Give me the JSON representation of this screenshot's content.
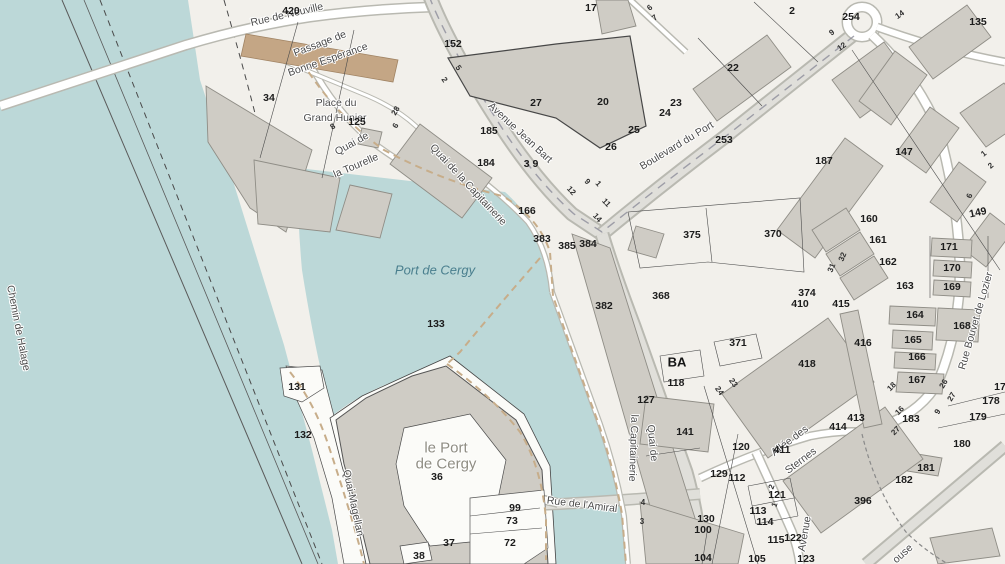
{
  "map_title": "Port de Cergy cadastral map",
  "colors": {
    "land": "#f2f0eb",
    "water": "#bcd8d8",
    "green": "#e7eeda",
    "green2": "#dce6c9",
    "parcel": "#fbfbf8",
    "bld": "#cfccc5",
    "bldstroke": "#8f8d86",
    "tan": "#c4a685",
    "road": "#ffffff",
    "major": "#e0dfda",
    "casing": "#b9b9b1",
    "quay": "#c7ad8a"
  },
  "labels": {
    "streets": [
      {
        "t": "Rue de Neuville",
        "x": 287,
        "y": 15,
        "r": -13
      },
      {
        "t": "Passage de",
        "x": 320,
        "y": 44,
        "r": -21
      },
      {
        "t": "Bonne Espérance",
        "x": 328,
        "y": 60,
        "r": -19
      },
      {
        "t": "Place du",
        "x": 336,
        "y": 103,
        "r": 0
      },
      {
        "t": "Grand Hunier",
        "x": 335,
        "y": 118,
        "r": 0
      },
      {
        "t": "Quai de",
        "x": 352,
        "y": 144,
        "r": -29
      },
      {
        "t": "la Tourelle",
        "x": 356,
        "y": 166,
        "r": -23
      },
      {
        "t": "Avenue Jean Bart",
        "x": 520,
        "y": 133,
        "r": 43
      },
      {
        "t": "Boulevard du Port",
        "x": 677,
        "y": 146,
        "r": -31
      },
      {
        "t": "Quai de la Capitainerie",
        "x": 468,
        "y": 185,
        "r": 47
      },
      {
        "t": "Quai de",
        "x": 652,
        "y": 443,
        "r": 84
      },
      {
        "t": "la Capitainerie",
        "x": 633,
        "y": 448,
        "r": 92
      },
      {
        "t": "Quai Magellan",
        "x": 353,
        "y": 503,
        "r": 78
      },
      {
        "t": "Rue de l'Amiral",
        "x": 582,
        "y": 505,
        "r": 7
      },
      {
        "t": "Chemin de Halage",
        "x": 18,
        "y": 328,
        "r": 79
      },
      {
        "t": "Allée des",
        "x": 790,
        "y": 441,
        "r": -37
      },
      {
        "t": "Sternes",
        "x": 801,
        "y": 461,
        "r": -37
      },
      {
        "t": "Rue Bouvet de Lozier",
        "x": 976,
        "y": 321,
        "r": -74
      },
      {
        "t": "Avenue",
        "x": 805,
        "y": 534,
        "r": -80
      },
      {
        "t": "ouse",
        "x": 903,
        "y": 554,
        "r": -42
      }
    ],
    "places": [
      {
        "t": "le Port",
        "x": 446,
        "y": 448,
        "r": 0
      },
      {
        "t": "de Cergy",
        "x": 446,
        "y": 464,
        "r": 0
      }
    ],
    "water_names": [
      {
        "t": "Port de Cergy",
        "x": 435,
        "y": 270,
        "r": 0
      }
    ],
    "sections": [
      {
        "t": "BA",
        "x": 677,
        "y": 362,
        "r": 0
      }
    ],
    "parcels": [
      {
        "t": "420",
        "x": 291,
        "y": 11
      },
      {
        "t": "152",
        "x": 453,
        "y": 44
      },
      {
        "t": "17",
        "x": 591,
        "y": 8
      },
      {
        "t": "34",
        "x": 269,
        "y": 98
      },
      {
        "t": "125",
        "x": 357,
        "y": 122
      },
      {
        "t": "185",
        "x": 489,
        "y": 131
      },
      {
        "t": "184",
        "x": 486,
        "y": 163
      },
      {
        "t": "3 9",
        "x": 531,
        "y": 164
      },
      {
        "t": "166",
        "x": 527,
        "y": 211
      },
      {
        "t": "383",
        "x": 542,
        "y": 239
      },
      {
        "t": "385",
        "x": 567,
        "y": 246
      },
      {
        "t": "384",
        "x": 588,
        "y": 244
      },
      {
        "t": "27",
        "x": 536,
        "y": 103
      },
      {
        "t": "20",
        "x": 603,
        "y": 102
      },
      {
        "t": "22",
        "x": 733,
        "y": 68
      },
      {
        "t": "23",
        "x": 676,
        "y": 103
      },
      {
        "t": "24",
        "x": 665,
        "y": 113
      },
      {
        "t": "25",
        "x": 634,
        "y": 130
      },
      {
        "t": "26",
        "x": 611,
        "y": 147
      },
      {
        "t": "253",
        "x": 724,
        "y": 140
      },
      {
        "t": "254",
        "x": 851,
        "y": 17
      },
      {
        "t": "2",
        "x": 792,
        "y": 11
      },
      {
        "t": "135",
        "x": 978,
        "y": 22
      },
      {
        "t": "147",
        "x": 904,
        "y": 152
      },
      {
        "t": "187",
        "x": 824,
        "y": 161
      },
      {
        "t": "160",
        "x": 869,
        "y": 219
      },
      {
        "t": "161",
        "x": 878,
        "y": 240
      },
      {
        "t": "162",
        "x": 888,
        "y": 262
      },
      {
        "t": "163",
        "x": 905,
        "y": 286
      },
      {
        "t": "149",
        "x": 978,
        "y": 213,
        "r": -12
      },
      {
        "t": "171",
        "x": 949,
        "y": 247
      },
      {
        "t": "170",
        "x": 952,
        "y": 268
      },
      {
        "t": "169",
        "x": 952,
        "y": 287
      },
      {
        "t": "168",
        "x": 962,
        "y": 326
      },
      {
        "t": "164",
        "x": 915,
        "y": 315
      },
      {
        "t": "165",
        "x": 913,
        "y": 340
      },
      {
        "t": "166",
        "x": 917,
        "y": 357
      },
      {
        "t": "167",
        "x": 917,
        "y": 380
      },
      {
        "t": "178",
        "x": 991,
        "y": 401
      },
      {
        "t": "179",
        "x": 978,
        "y": 417
      },
      {
        "t": "180",
        "x": 962,
        "y": 444
      },
      {
        "t": "181",
        "x": 926,
        "y": 468
      },
      {
        "t": "182",
        "x": 904,
        "y": 480
      },
      {
        "t": "183",
        "x": 911,
        "y": 419
      },
      {
        "t": "17",
        "x": 1000,
        "y": 387
      },
      {
        "t": "375",
        "x": 692,
        "y": 235
      },
      {
        "t": "370",
        "x": 773,
        "y": 234
      },
      {
        "t": "368",
        "x": 661,
        "y": 296
      },
      {
        "t": "382",
        "x": 604,
        "y": 306
      },
      {
        "t": "371",
        "x": 738,
        "y": 343
      },
      {
        "t": "374",
        "x": 807,
        "y": 293
      },
      {
        "t": "410",
        "x": 800,
        "y": 304
      },
      {
        "t": "415",
        "x": 841,
        "y": 304
      },
      {
        "t": "416",
        "x": 863,
        "y": 343
      },
      {
        "t": "411",
        "x": 782,
        "y": 450
      },
      {
        "t": "413",
        "x": 856,
        "y": 418
      },
      {
        "t": "414",
        "x": 838,
        "y": 427
      },
      {
        "t": "418",
        "x": 807,
        "y": 364
      },
      {
        "t": "396",
        "x": 863,
        "y": 501
      },
      {
        "t": "118",
        "x": 676,
        "y": 383
      },
      {
        "t": "127",
        "x": 646,
        "y": 400
      },
      {
        "t": "141",
        "x": 685,
        "y": 432
      },
      {
        "t": "120",
        "x": 741,
        "y": 447
      },
      {
        "t": "129",
        "x": 719,
        "y": 474
      },
      {
        "t": "112",
        "x": 737,
        "y": 478
      },
      {
        "t": "121",
        "x": 777,
        "y": 495
      },
      {
        "t": "113",
        "x": 758,
        "y": 511
      },
      {
        "t": "114",
        "x": 765,
        "y": 522
      },
      {
        "t": "130",
        "x": 706,
        "y": 519
      },
      {
        "t": "100",
        "x": 703,
        "y": 530
      },
      {
        "t": "115",
        "x": 776,
        "y": 540
      },
      {
        "t": "122",
        "x": 793,
        "y": 538
      },
      {
        "t": "104",
        "x": 703,
        "y": 558
      },
      {
        "t": "105",
        "x": 757,
        "y": 559
      },
      {
        "t": "123",
        "x": 806,
        "y": 559
      },
      {
        "t": "99",
        "x": 515,
        "y": 508
      },
      {
        "t": "73",
        "x": 512,
        "y": 521
      },
      {
        "t": "72",
        "x": 510,
        "y": 543
      },
      {
        "t": "37",
        "x": 449,
        "y": 543
      },
      {
        "t": "38",
        "x": 419,
        "y": 556
      },
      {
        "t": "36",
        "x": 437,
        "y": 477
      },
      {
        "t": "131",
        "x": 297,
        "y": 387
      },
      {
        "t": "132",
        "x": 303,
        "y": 435
      },
      {
        "t": "133",
        "x": 436,
        "y": 324
      }
    ],
    "house_numbers": [
      {
        "t": "6",
        "x": 650,
        "y": 8,
        "r": -40
      },
      {
        "t": "7",
        "x": 655,
        "y": 18,
        "r": -40
      },
      {
        "t": "5",
        "x": 458,
        "y": 68,
        "r": 55
      },
      {
        "t": "2",
        "x": 444,
        "y": 80,
        "r": 55
      },
      {
        "t": "8",
        "x": 333,
        "y": 127,
        "r": -35
      },
      {
        "t": "28",
        "x": 396,
        "y": 111,
        "r": -60
      },
      {
        "t": "6",
        "x": 396,
        "y": 126,
        "r": -60
      },
      {
        "t": "9",
        "x": 832,
        "y": 33,
        "r": -35
      },
      {
        "t": "12",
        "x": 842,
        "y": 47,
        "r": -35
      },
      {
        "t": "14",
        "x": 900,
        "y": 15,
        "r": -35
      },
      {
        "t": "9",
        "x": 587,
        "y": 182,
        "r": 48
      },
      {
        "t": "1",
        "x": 598,
        "y": 184,
        "r": 48
      },
      {
        "t": "12",
        "x": 571,
        "y": 191,
        "r": 48
      },
      {
        "t": "11",
        "x": 606,
        "y": 203,
        "r": 48
      },
      {
        "t": "14",
        "x": 597,
        "y": 218,
        "r": 48
      },
      {
        "t": "23",
        "x": 733,
        "y": 383,
        "r": 55
      },
      {
        "t": "24",
        "x": 719,
        "y": 391,
        "r": 55
      },
      {
        "t": "32",
        "x": 843,
        "y": 257,
        "r": -68
      },
      {
        "t": "31",
        "x": 832,
        "y": 268,
        "r": -68
      },
      {
        "t": "1",
        "x": 984,
        "y": 154,
        "r": -40
      },
      {
        "t": "2",
        "x": 991,
        "y": 166,
        "r": -40
      },
      {
        "t": "6",
        "x": 970,
        "y": 196,
        "r": -70
      },
      {
        "t": "18",
        "x": 892,
        "y": 387,
        "r": -45
      },
      {
        "t": "16",
        "x": 900,
        "y": 411,
        "r": -45
      },
      {
        "t": "26",
        "x": 944,
        "y": 384,
        "r": -60
      },
      {
        "t": "27",
        "x": 952,
        "y": 397,
        "r": -60
      },
      {
        "t": "9",
        "x": 938,
        "y": 412,
        "r": -60
      },
      {
        "t": "27",
        "x": 896,
        "y": 431,
        "r": -45
      },
      {
        "t": "4",
        "x": 643,
        "y": 503,
        "r": 0
      },
      {
        "t": "3",
        "x": 642,
        "y": 522,
        "r": 0
      },
      {
        "t": "2",
        "x": 772,
        "y": 487,
        "r": -70
      },
      {
        "t": "1",
        "x": 775,
        "y": 505,
        "r": -70
      }
    ]
  }
}
